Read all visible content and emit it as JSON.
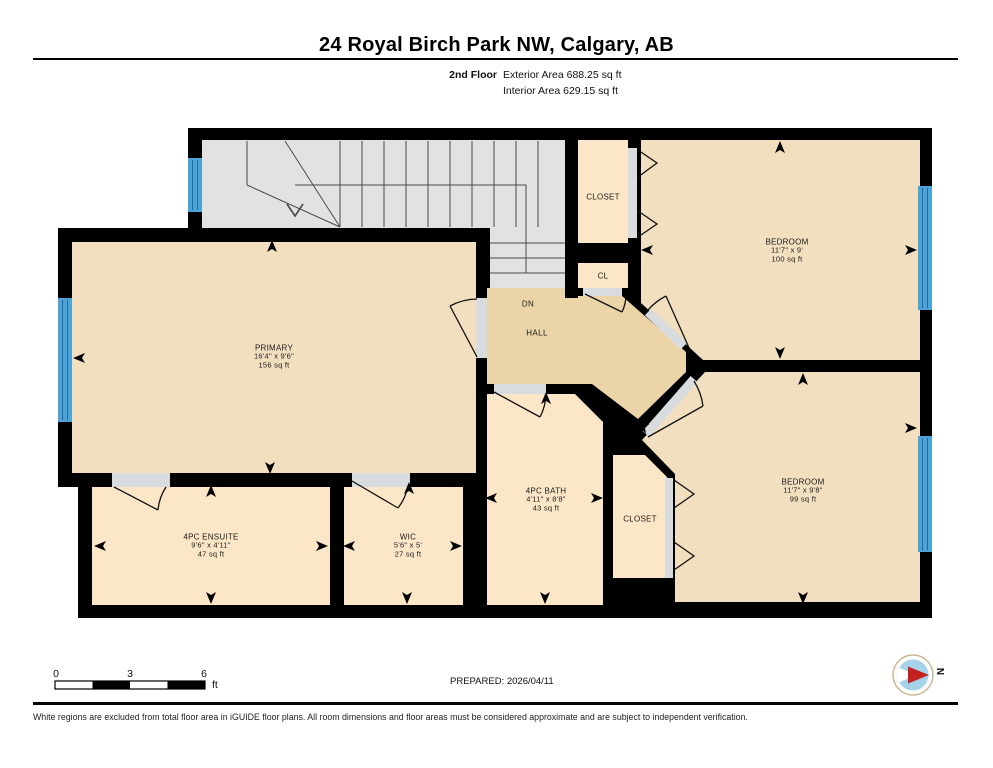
{
  "header": {
    "title": "24 Royal Birch Park NW, Calgary, AB",
    "floor_label": "2nd Floor",
    "exterior_area": "Exterior Area 688.25 sq ft",
    "interior_area": "Interior Area 629.15 sq ft"
  },
  "rooms": {
    "primary": {
      "name": "PRIMARY",
      "dims": "16'4\" x 9'6\"",
      "area": "156 sq ft"
    },
    "bedroom1": {
      "name": "BEDROOM",
      "dims": "11'7\" x 9'",
      "area": "100 sq ft"
    },
    "bedroom2": {
      "name": "BEDROOM",
      "dims": "11'7\" x 9'8\"",
      "area": "99 sq ft"
    },
    "bath": {
      "name": "4PC BATH",
      "dims": "4'11\" x 8'8\"",
      "area": "43 sq ft"
    },
    "ensuite": {
      "name": "4PC ENSUITE",
      "dims": "9'6\" x 4'11\"",
      "area": "47 sq ft"
    },
    "wic": {
      "name": "WIC",
      "dims": "5'6\" x 5'",
      "area": "27 sq ft"
    },
    "closet_top": {
      "name": "CLOSET"
    },
    "cl": {
      "name": "CL"
    },
    "closet_mid": {
      "name": "CLOSET"
    },
    "hall": {
      "name": "HALL"
    },
    "stairs_dn": {
      "name": "DN"
    }
  },
  "footer": {
    "scale_ticks": [
      "0",
      "3",
      "6"
    ],
    "scale_unit": "ft",
    "prepared": "PREPARED: 2026/04/11",
    "compass_label": "N",
    "disclaimer": "White regions are excluded from total floor area in iGUIDE floor plans. All room dimensions and floor areas must be considered approximate and are subject to independent verification."
  },
  "colors": {
    "wall": "#000000",
    "room": "#f2dfbf",
    "room_light": "#fbe7c7",
    "hall": "#ebd5a8",
    "stairs": "#e2e2e2",
    "opening": "#d8dcdf",
    "window": "#4da3d6",
    "compass_blue": "#a6d3ea",
    "compass_red": "#c42222"
  }
}
